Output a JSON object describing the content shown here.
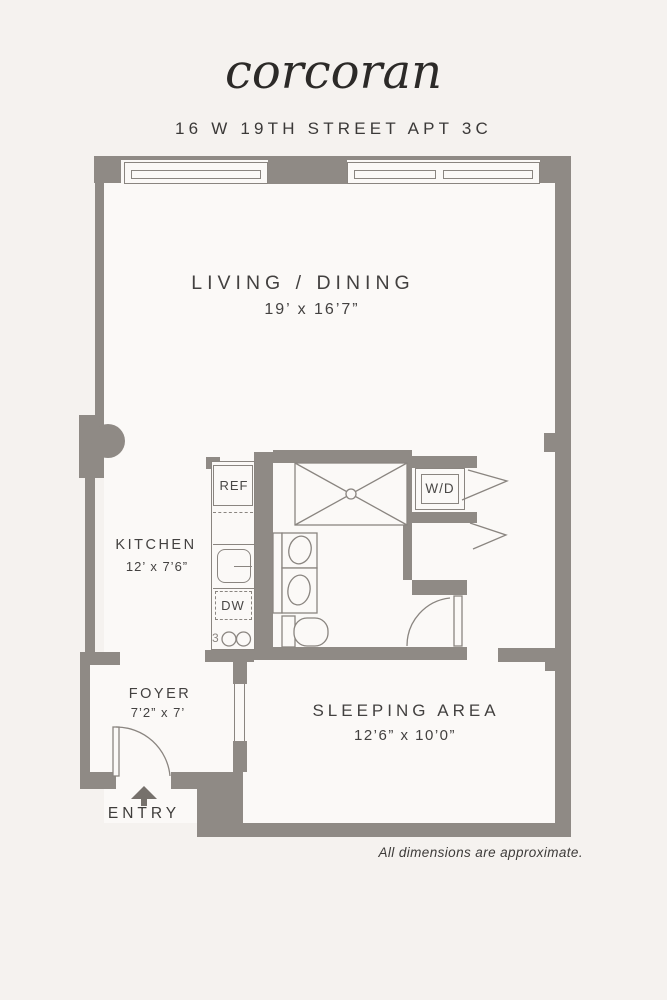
{
  "brand": {
    "name": "corcoran"
  },
  "listing": {
    "address": "16 W 19TH STREET APT 3C"
  },
  "rooms": {
    "living": {
      "name": "LIVING / DINING",
      "dims": "19’ x 16’7”"
    },
    "kitchen": {
      "name": "KITCHEN",
      "dims": "12’ x 7’6”"
    },
    "foyer": {
      "name": "FOYER",
      "dims": "7’2” x 7’"
    },
    "sleeping": {
      "name": "SLEEPING AREA",
      "dims": "12’6” x 10’0”"
    }
  },
  "fixtures": {
    "refrigerator": "REF",
    "dishwasher": "DW",
    "washer_dryer": "W/D",
    "stove_mark": "3"
  },
  "entry": {
    "label": "ENTRY"
  },
  "footer": {
    "note": "All dimensions are approximate."
  },
  "colors": {
    "wall": "#8f8a85",
    "line": "#8a8580",
    "text": "#434140",
    "background": "#f5f2ef",
    "paper": "#fbf9f7"
  }
}
